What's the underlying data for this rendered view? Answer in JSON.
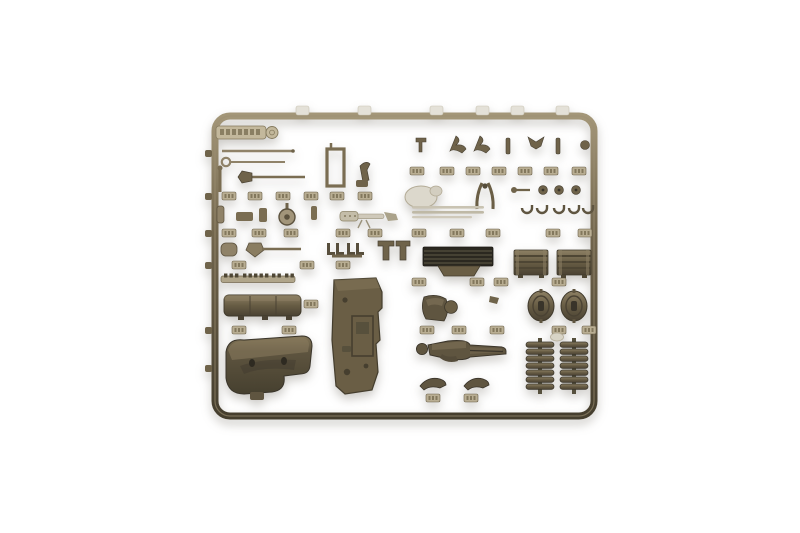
{
  "scene": {
    "type": "product-photograph",
    "description": "Olive-drab injection-molded plastic model kit sprue (parts tree) photographed on a plain white background",
    "background": "plain white, softly lit, faint shadow beneath the sprue",
    "sprue": {
      "shape": "rounded rectangular frame with internal grid of runners",
      "plastic_color_name": "olive drab",
      "brand_tag": {
        "present": true,
        "location": "top-left rail",
        "text_legible": false,
        "appearance": "embossed molded nameplate with a small circular mark at its right end"
      },
      "part_number_tabs": "small embossed rectangular number tabs spaced along every runner (numbers not legible)"
    },
    "part_groups": [
      {
        "name": "thin-rods-and-ring-tool",
        "area": "top-left"
      },
      {
        "name": "pioneer-tools-axe-and-frame-part",
        "area": "top-left"
      },
      {
        "name": "gauge-cylinder-and-machine-gun",
        "area": "mid-left row"
      },
      {
        "name": "shovel-blades-and-boot-pairs",
        "area": "left row"
      },
      {
        "name": "toothed-rack-strip",
        "area": "left"
      },
      {
        "name": "long-stowage-bin",
        "area": "left"
      },
      {
        "name": "large-hull-panel",
        "area": "center, tall flat plate with hatch detail"
      },
      {
        "name": "curved-engine-cowl",
        "area": "bottom-left, dark curved hood"
      },
      {
        "name": "small-brackets-row",
        "area": "top-right, eight short vertical runners"
      },
      {
        "name": "canteen-blob-pliers-rods-and-hooks",
        "area": "upper-right row, some parts overexposed light"
      },
      {
        "name": "dark-louvered-grille",
        "area": "center-right"
      },
      {
        "name": "two-stowage-crates",
        "area": "right"
      },
      {
        "name": "figure-torso-bust",
        "area": "center-right"
      },
      {
        "name": "two-oval-hatch-wheels",
        "area": "right"
      },
      {
        "name": "standing-soldier-figure-horizontal",
        "area": "bottom-center-right"
      },
      {
        "name": "two-arm-parts",
        "area": "bottom-center"
      },
      {
        "name": "two-ribbed-spring-stacks",
        "area": "bottom-right"
      }
    ]
  },
  "colors": {
    "bg": "#ffffff",
    "sprue-hi": "#a39678",
    "sprue-mid": "#71654c",
    "sprue-dark": "#453e2e",
    "tab-light": "#b9ae93",
    "part-dark": "#5a5140",
    "part-darker": "#39342a",
    "blown-light": "#e4e1d8",
    "light-gray": "#ccc7b8",
    "grille-dark": "#2b2820"
  }
}
